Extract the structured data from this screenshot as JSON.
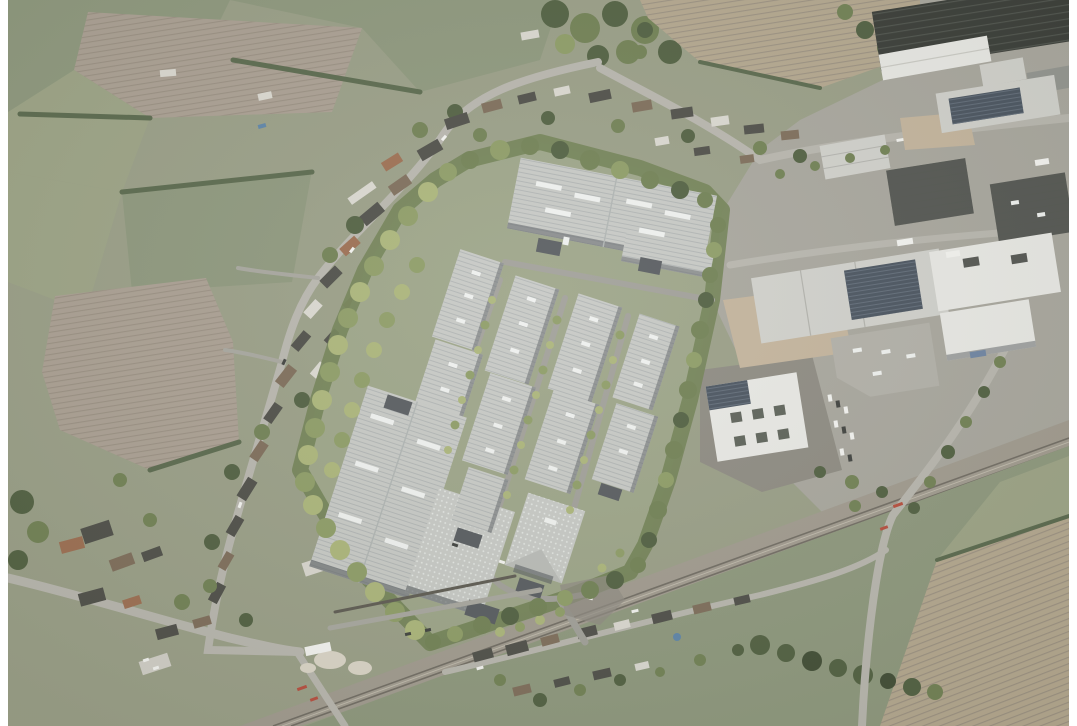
{
  "window": {
    "background": "#ffffff"
  },
  "scene": {
    "type": "aerial-photomontage",
    "alt": "Oblique aerial photograph of a proposed business park: rows of light grey solar-roofed warehouse units inside a tree-lined site, a village street with houses to the west, an existing industrial estate to the east, farmland on all sides and a railway line crossing the lower part of the image.",
    "regions": {
      "fields_northwest": "Farmland, ploughed fields and paddocks north-west of the village",
      "fields_northeast": "Ploughed field and crop rows north-east of the industrial estate",
      "village_west": "Village street with houses and gardens west of the site",
      "village_north": "Houses along the road north of the site",
      "development_site": "Proposed business park inside a tree-lined boundary",
      "warehouses": "New warehouse units with standing-seam solar roofs and rooflights",
      "site_roads": "Internal estate roads with young street trees",
      "tree_belt": "Green landscape buffer around the development site",
      "industrial_estate_east": "Existing industrial estate east of the site",
      "office_building": "White office building with roof courtyards and solar array",
      "railway": "Multi-track railway line with level crossings",
      "sidings": "Gravel yard and stockpiles beside the railway",
      "fields_southeast": "Pasture and ploughed field south-east of the railway",
      "houses_south": "Houses along the road south of the railway"
    }
  },
  "palette": {
    "paper": "#ffffff",
    "base": "#979c84",
    "fieldGreen": "#8b957a",
    "fieldPale": "#9aa183",
    "fieldTan": "#b2a58c",
    "plough": "#a89d90",
    "ploughLine": "#94897c",
    "cropRow": "#7e8a64",
    "woodland": "#57664a",
    "treeDark": "#4e5d3e",
    "treeMid": "#6e7e51",
    "treeLight": "#8b9a63",
    "treeYoung": "#a9b377",
    "road": "#b6b4ac",
    "roadMinor": "#a5a49c",
    "siteGround": "#9aa285",
    "siteRoad": "#9e9d96",
    "roof": "#c5c7c3",
    "roofSeam": "#9aa0a2",
    "facadeDark": "#54585c",
    "skylight": "#eef0ee",
    "pv": "#46505c",
    "pvLine": "#5f6a78",
    "estateGround": "#a6a49b",
    "roofWhite": "#e7e7e3",
    "roofLight": "#cfcfca",
    "roofMid": "#90928d",
    "roofDark": "#50524e",
    "roofDarker": "#353833",
    "railBed": "#9e988c",
    "railLine": "#6e6960",
    "dirt": "#c2b29a",
    "sand": "#d9d3c5",
    "pool": "#5b82a6",
    "carWhite": "#f2f2ef",
    "carDark": "#3c3e3b",
    "redMark": "#b44a3a",
    "houseDark": "#4b4b45",
    "houseBrown": "#7b6a57",
    "houseOrange": "#9a6b4e",
    "houseWhite": "#d9d7cf",
    "wall": "#5a574e",
    "tarmac": "#8b887f"
  }
}
